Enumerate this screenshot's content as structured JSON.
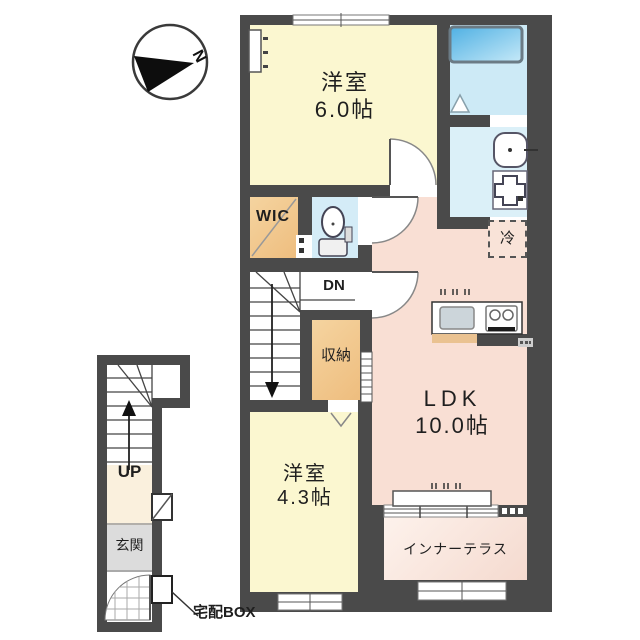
{
  "compass": {
    "north_label": "N"
  },
  "floor_plan": {
    "rooms": {
      "western_room_6": {
        "name": "洋室",
        "size": "6.0帖"
      },
      "wic": {
        "name": "WIC"
      },
      "storage": {
        "name": "収納"
      },
      "ldk": {
        "name": "LDK",
        "size": "10.0帖"
      },
      "western_room_43": {
        "name": "洋室",
        "size": "4.3帖"
      },
      "inner_terrace": {
        "name": "インナーテラス"
      },
      "entrance": {
        "name": "玄関"
      }
    },
    "annotations": {
      "stairs_up": "UP",
      "stairs_down": "DN",
      "refrigerator": "冷",
      "delivery_box": "宅配BOX"
    },
    "colors": {
      "wall": "#4a4a4a",
      "room_yellow": "#fbf7d0",
      "room_orange": "#eebd7e",
      "room_blue": "#d4ecf7",
      "room_pink": "#f9dfd4",
      "bathtub_blue": "#55b2e4",
      "entrance_grey": "#dcdcdc",
      "hall_beige": "#faf0dd"
    }
  }
}
